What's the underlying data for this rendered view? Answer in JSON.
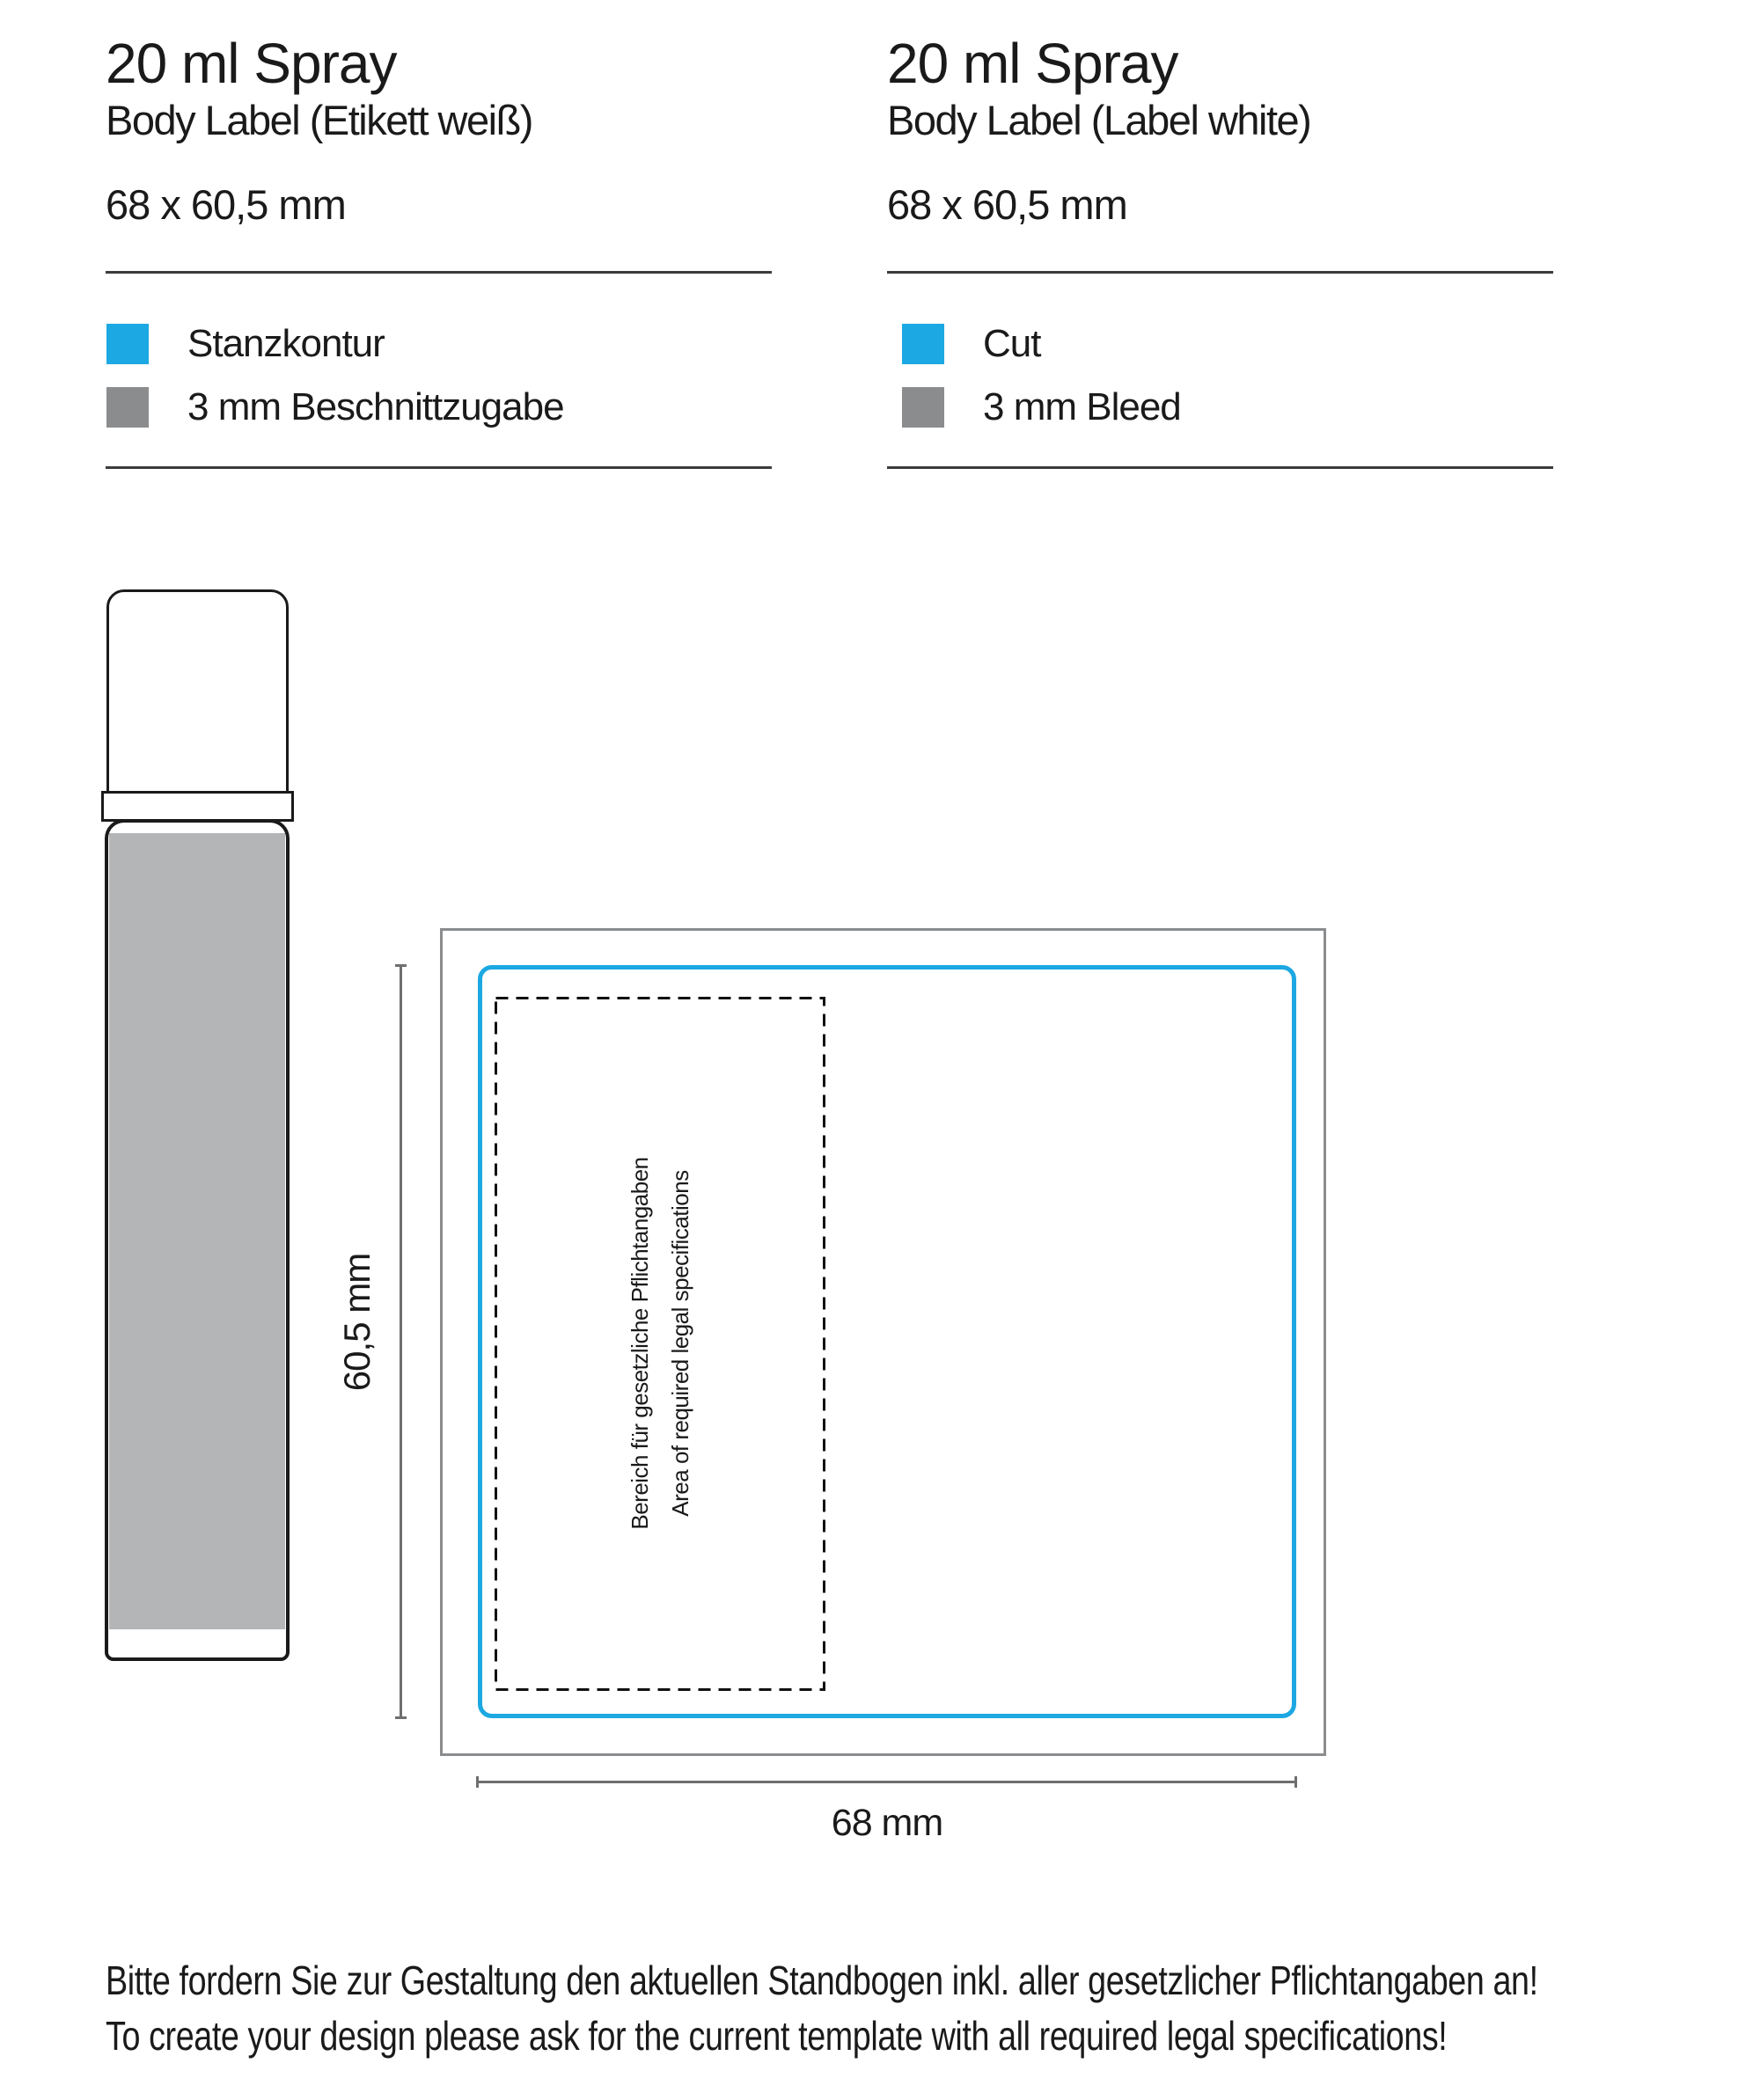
{
  "columns": [
    {
      "title": "20 ml Spray",
      "subtitle": "Body Label (Etikett weiß)",
      "dimensions": "68 x 60,5 mm",
      "legend": [
        {
          "label": "Stanzkontur",
          "color": "#1ca8e2"
        },
        {
          "label": "3 mm Beschnittzugabe",
          "color": "#8a8c8e"
        }
      ]
    },
    {
      "title": "20 ml Spray",
      "subtitle": "Body Label (Label white)",
      "dimensions": "68 x 60,5 mm",
      "legend": [
        {
          "label": "Cut",
          "color": "#1ca8e2"
        },
        {
          "label": "3 mm Bleed",
          "color": "#8a8c8e"
        }
      ]
    }
  ],
  "diagram": {
    "legal_area_line1": "Bereich für gesetzliche Pflichtangaben",
    "legal_area_line2": "Area of required legal specifications",
    "height_label": "60,5 mm",
    "width_label": "68 mm"
  },
  "footer": {
    "line1": "Bitte fordern Sie zur Gestaltung den aktuellen Standbogen inkl. aller gesetzlicher Pflichtangaben an!",
    "line2": "To create your design please ask for the current template with all required legal specifications!"
  },
  "colors": {
    "cut_cyan": "#1ca8e2",
    "bleed_gray": "#8a8c8e",
    "bottle_label_gray": "#b3b5b7",
    "rule_dark": "#3c3c3b",
    "dimension_gray": "#706f6f"
  }
}
